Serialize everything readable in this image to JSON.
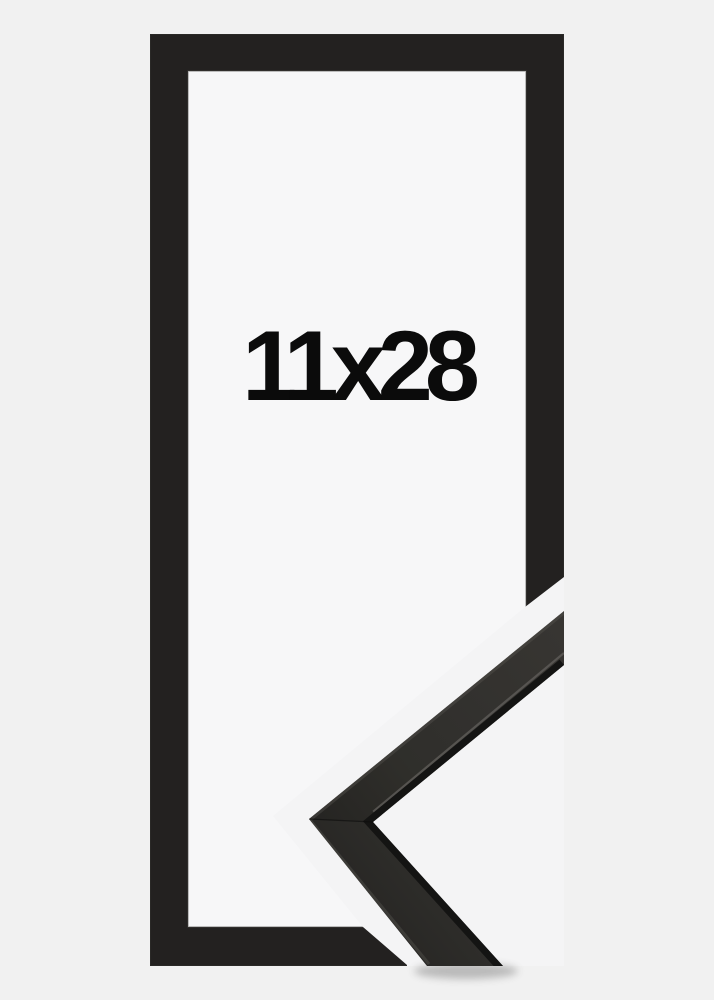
{
  "product": {
    "size_label": "11x28"
  },
  "colors": {
    "background": "#f1f1f1",
    "frame": "#232120",
    "frame_edge_line": "#2e2d2b",
    "frame_interior": "#f7f7f8",
    "interior_bevel": "#4a4948",
    "cutout": "#f4f4f5",
    "label": "#0b0b0b",
    "sample_edge": "#141413",
    "sample_highlight": "#5d5b57",
    "sample_outer_bevel": "#55534e"
  }
}
